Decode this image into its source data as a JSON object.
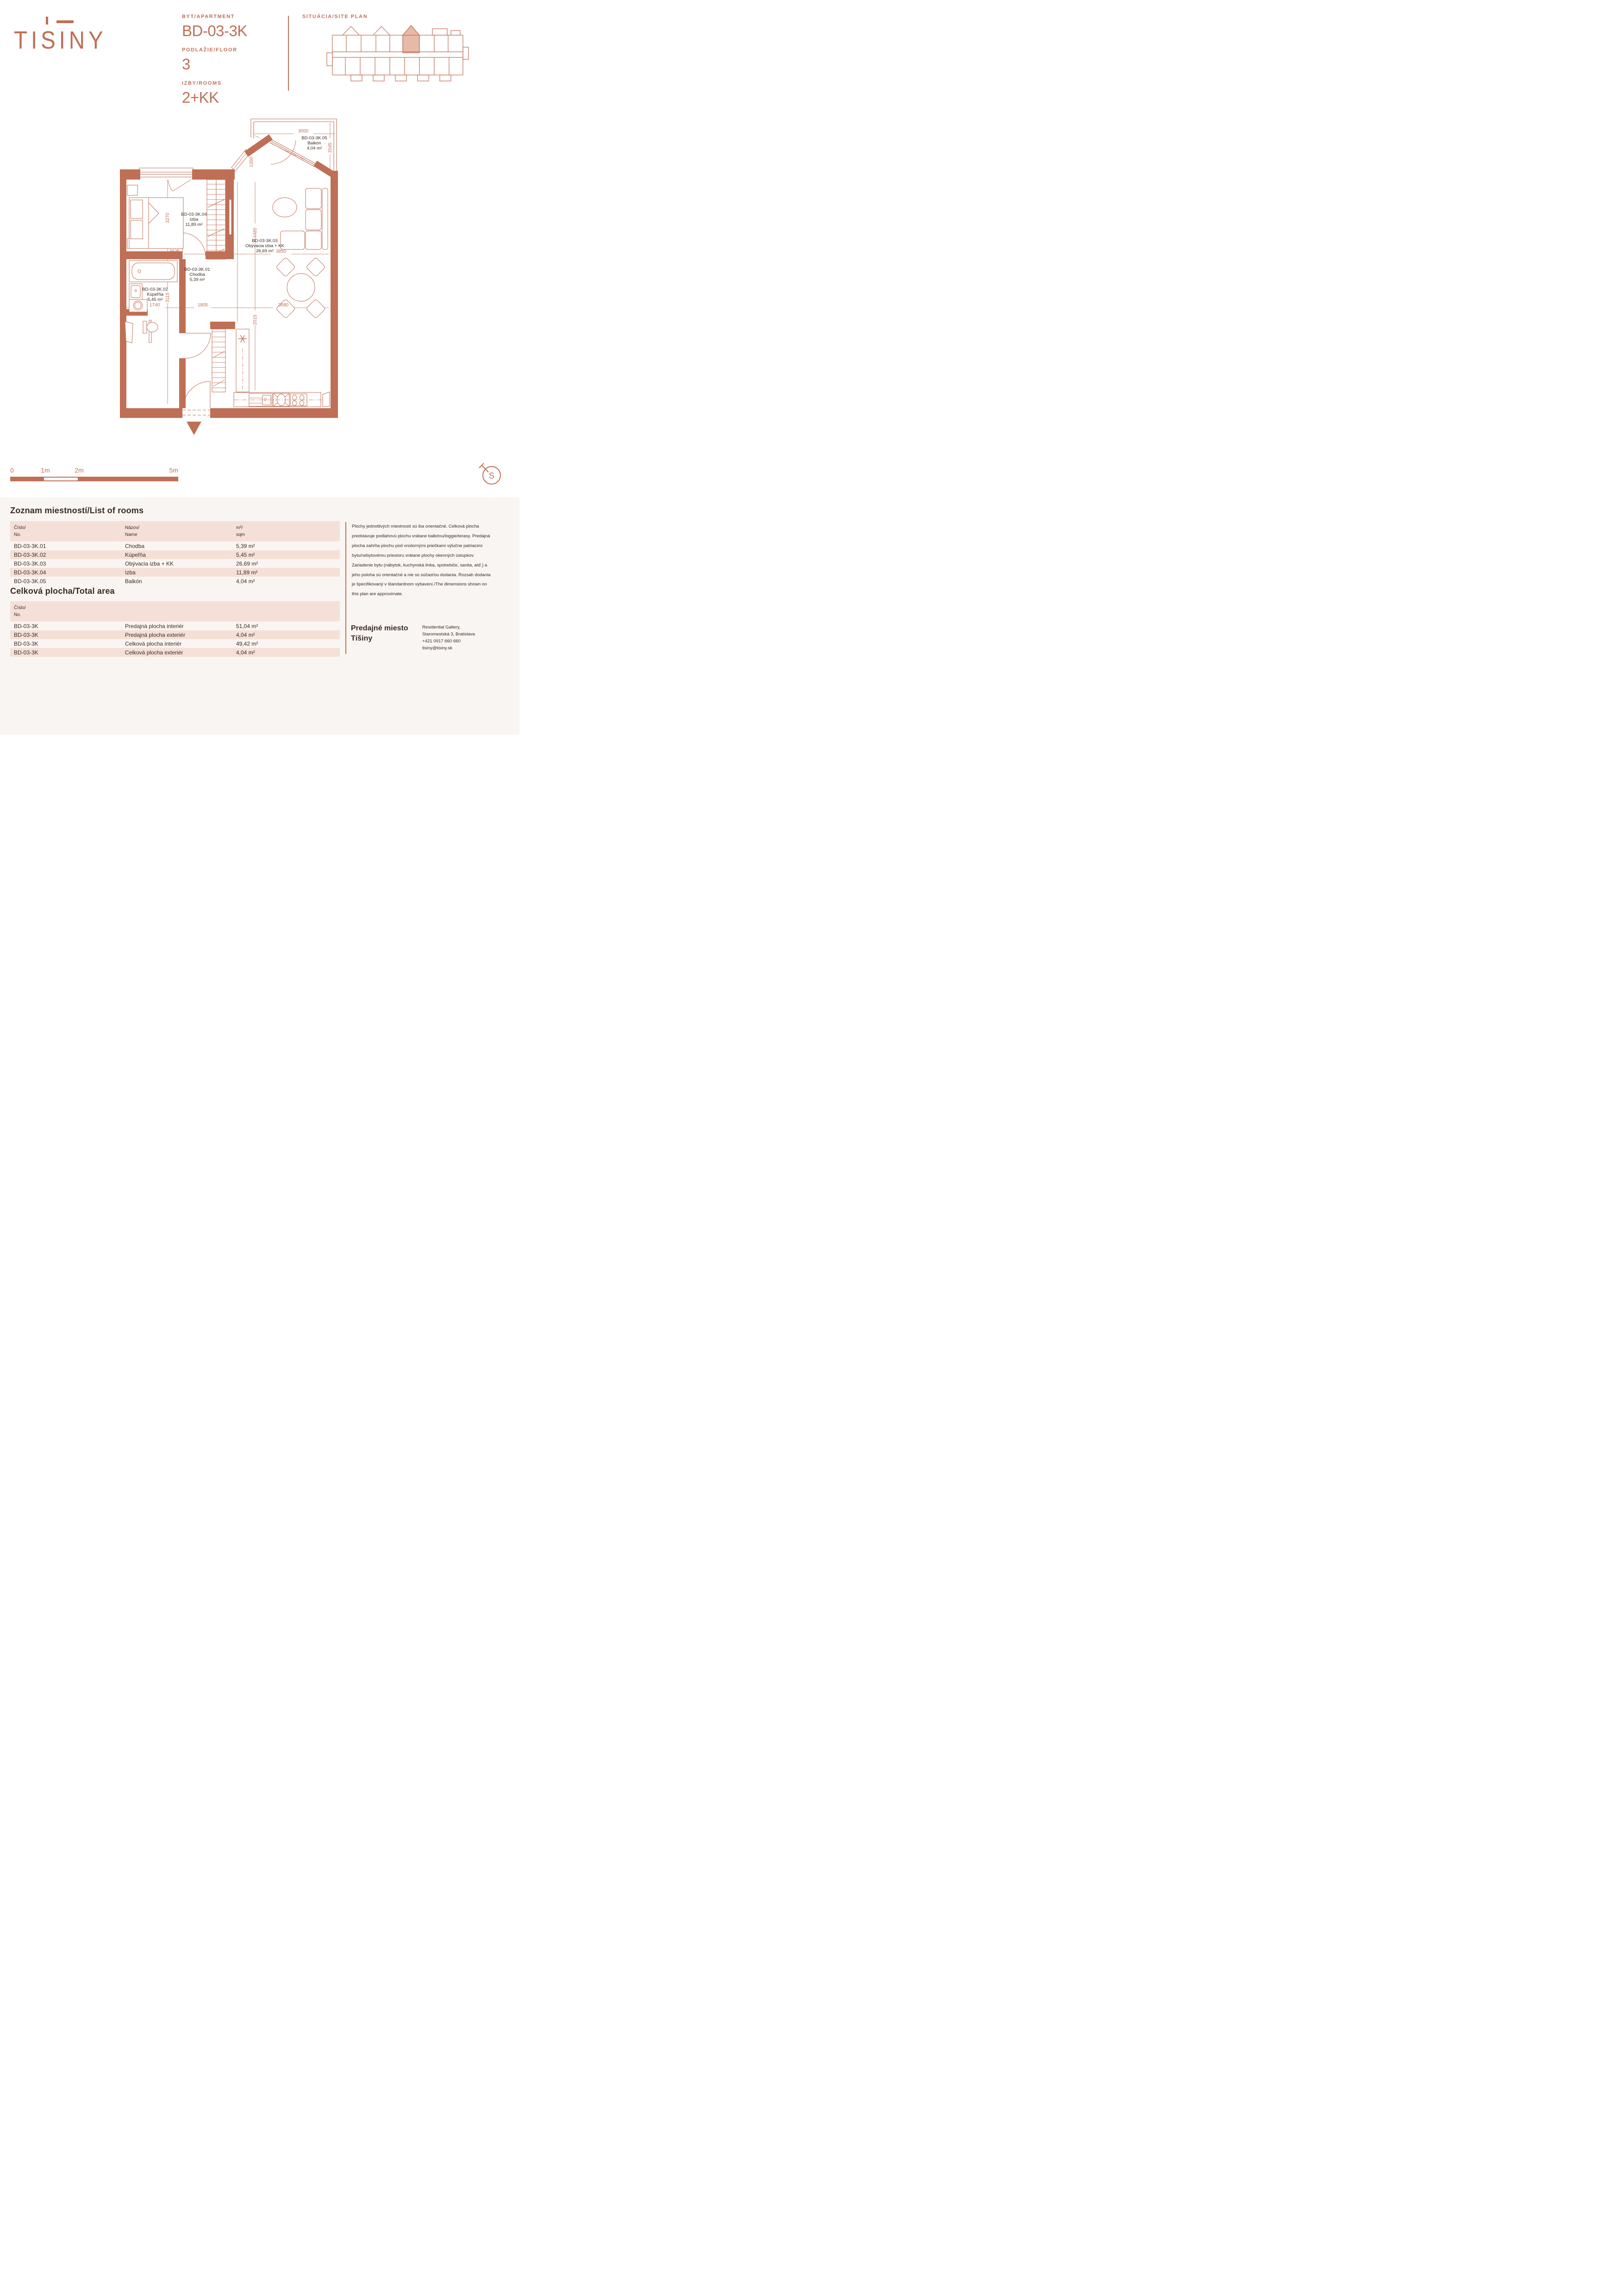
{
  "colors": {
    "accent": "#bf6f55",
    "accent_fill_light": "#e8b9a6",
    "text_dark": "#3a2a22",
    "row_pink": "#f5e0d7",
    "section_bg": "#f9f5f2"
  },
  "logo": {
    "text": "TISINY"
  },
  "header": {
    "apartment_label": "BYT/APARTMENT",
    "apartment_value": "BD-03-3K",
    "floor_label": "PODLAŽIE/FLOOR",
    "floor_value": "3",
    "rooms_label": "IZBY/ROOMS",
    "rooms_value": "2+KK",
    "siteplan_label": "SITUÁCIA/SITE PLAN"
  },
  "plan": {
    "rooms": {
      "hall": {
        "id": "BD-03-3K.01",
        "name": "Chodba",
        "area": "5,39 m²"
      },
      "bath": {
        "id": "BD-03-3K.02",
        "name": "Kúpeľňa",
        "area": "5,45 m²"
      },
      "living": {
        "id": "BD-03-3K.03",
        "name": "Obývacia izba + KK",
        "area": "26,69 m²"
      },
      "bedroom": {
        "id": "BD-03-3K.04",
        "name": "Izba",
        "area": "11,89 m²"
      },
      "balcony": {
        "id": "BD-03-3K.05",
        "name": "Balkón",
        "area": "4,04 m²"
      }
    },
    "dims": {
      "balcony_width": "3000",
      "balcony_depth": "2045",
      "balcony_side": "1350",
      "bedroom_depth": "3270",
      "bedroom_width": "3635",
      "living_depth": "4485",
      "living_width": "3850",
      "bath_width": "1740",
      "bath_depth": "3115",
      "hall_width": "1805",
      "kitchen_depth": "2015",
      "kitchen_width": "3680"
    }
  },
  "scalebar": {
    "labels": [
      "0",
      "1m",
      "2m",
      "5m"
    ]
  },
  "compass": {
    "label": "S"
  },
  "rooms_table": {
    "title": "Zoznam miestností/List of rooms",
    "headers": [
      [
        "Číslo/",
        "No."
      ],
      [
        "Názov/",
        "Name"
      ],
      [
        "m²/",
        "sqm"
      ]
    ],
    "rows": [
      [
        "BD-03-3K.01",
        "Chodba",
        "5,39 m²"
      ],
      [
        "BD-03-3K.02",
        "Kúpeľňa",
        "5,45 m²"
      ],
      [
        "BD-03-3K.03",
        "Obývacia izba + KK",
        "26,69 m²"
      ],
      [
        "BD-03-3K.04",
        "Izba",
        "11,89 m²"
      ],
      [
        "BD-03-3K.05",
        "Balkón",
        "4,04 m²"
      ]
    ]
  },
  "total_table": {
    "title": "Celková plocha/Total area",
    "header": [
      "Číslo/",
      "No."
    ],
    "rows": [
      [
        "BD-03-3K",
        "Predajná plocha interiér",
        "51,04 m²"
      ],
      [
        "BD-03-3K",
        "Predajná plocha exteriér",
        "4,04 m²"
      ],
      [
        "BD-03-3K",
        "Celková plocha interiér",
        "49,42 m²"
      ],
      [
        "BD-03-3K",
        "Celková plocha exteriér",
        "4,04 m²"
      ]
    ]
  },
  "disclaimer": "Plochy jednotlivých miestností sú iba orientačné. Celková plocha predstavuje podlahovú plochu vrátane balkónu/loggie/terasy. Predajná plocha zahŕňa plochu pod vnútornými priečkami výlučne patriacimi bytu/nebytovému priestoru vrátane plochy okenných ústupkov. Zariadenie bytu (nábytok, kuchynská linka, spotrebiče, sanita, atď.) a jeho poloha sú orientačné a nie sú súčasťou dodania. Rozsah dodania je špecifikovaný v štandardnom vybavení./The dimensions shown on this plan are approximate.",
  "sales": {
    "title1": "Predajné miesto",
    "title2": "Tíšiny",
    "contact": [
      "Residential Gallery,",
      "Staromestská 3, Bratislava",
      "+421 0917 660 660",
      "tisiny@tisiny.sk"
    ]
  }
}
